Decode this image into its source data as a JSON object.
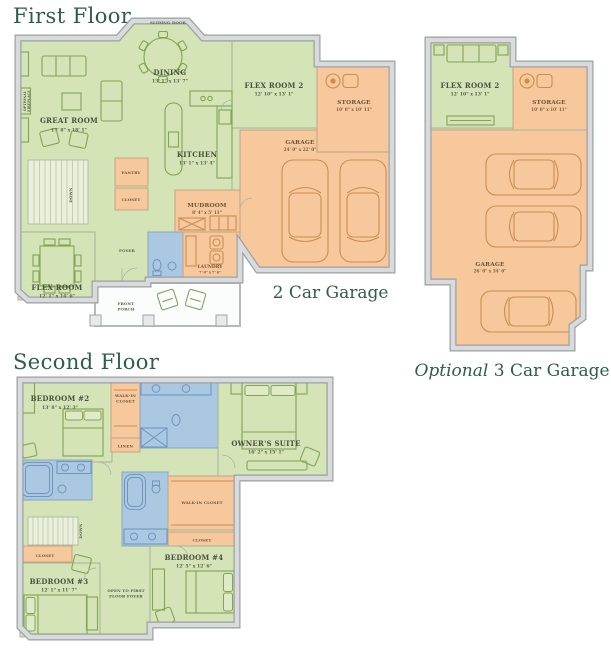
{
  "colors": {
    "room_green": "#d4e4b6",
    "room_orange": "#f7c89c",
    "room_blue": "#abc8e3",
    "wall_gray": "#d8dadb",
    "title_green": "#2e5e49"
  },
  "first_floor": {
    "title": "First Floor",
    "caption": "2 Car Garage",
    "labels": {
      "sliding_door": "SLIDING DOOR",
      "optional_fireplace_lines": [
        "OPTIONAL",
        "FIREPLACE"
      ],
      "down": "DOWN",
      "pantry": "PANTRY",
      "closet": "CLOSET",
      "foyer": "FOYER",
      "front_porch_lines": [
        "FRONT",
        "PORCH"
      ]
    },
    "rooms": {
      "great_room": {
        "name": "GREAT ROOM",
        "dims": "17' 8\" x 18' 1\""
      },
      "dining": {
        "name": "DINING",
        "dims": "13' 1\" x 13' 7\""
      },
      "kitchen": {
        "name": "KITCHEN",
        "dims": "13' 1\" x 13' 4\""
      },
      "flex_room_2": {
        "name": "FLEX ROOM 2",
        "dims": "12' 10\" x 13' 1\""
      },
      "storage": {
        "name": "STORAGE",
        "dims": "10' 0\" x 10' 11\""
      },
      "garage": {
        "name": "GARAGE",
        "dims": "24' 0\" x 22' 0\""
      },
      "mudroom": {
        "name": "MUDROOM",
        "dims": "8' 4\" x 5' 11\""
      },
      "laundry": {
        "name": "LAUNDRY",
        "dims": "7' 0\" x 7' 6\""
      },
      "flex_room": {
        "name": "FLEX ROOM",
        "dims": "12' 1\" x 14' 6\""
      }
    }
  },
  "optional_garage": {
    "caption_italic": "Optional",
    "caption_rest": "3 Car Garage",
    "rooms": {
      "flex_room_2": {
        "name": "FLEX ROOM 2",
        "dims": "12' 10\" x 13' 1\""
      },
      "storage": {
        "name": "STORAGE",
        "dims": "10' 0\" x 10' 11\""
      },
      "garage": {
        "name": "GARAGE",
        "dims": "26' 0\" x 34' 0\""
      }
    }
  },
  "second_floor": {
    "title": "Second Floor",
    "labels": {
      "walk_in_closet_lines": [
        "WALK-IN",
        "CLOSET"
      ],
      "walk_in_closet": "WALK-IN CLOSET",
      "linen": "LINEN",
      "closet": "CLOSET",
      "down": "DOWN",
      "open_foyer_lines": [
        "OPEN TO FIRST",
        "FLOOR FOYER"
      ]
    },
    "rooms": {
      "bedroom_2": {
        "name": "BEDROOM #2",
        "dims": "13' 8\" x 12' 3\""
      },
      "owners_suite": {
        "name": "OWNER'S SUITE",
        "dims": "16' 2\" x 15' 1\""
      },
      "bedroom_3": {
        "name": "BEDROOM #3",
        "dims": "12' 1\" x 11' 7\""
      },
      "bedroom_4": {
        "name": "BEDROOM #4",
        "dims": "12' 5\" x 12' 6\""
      }
    }
  }
}
